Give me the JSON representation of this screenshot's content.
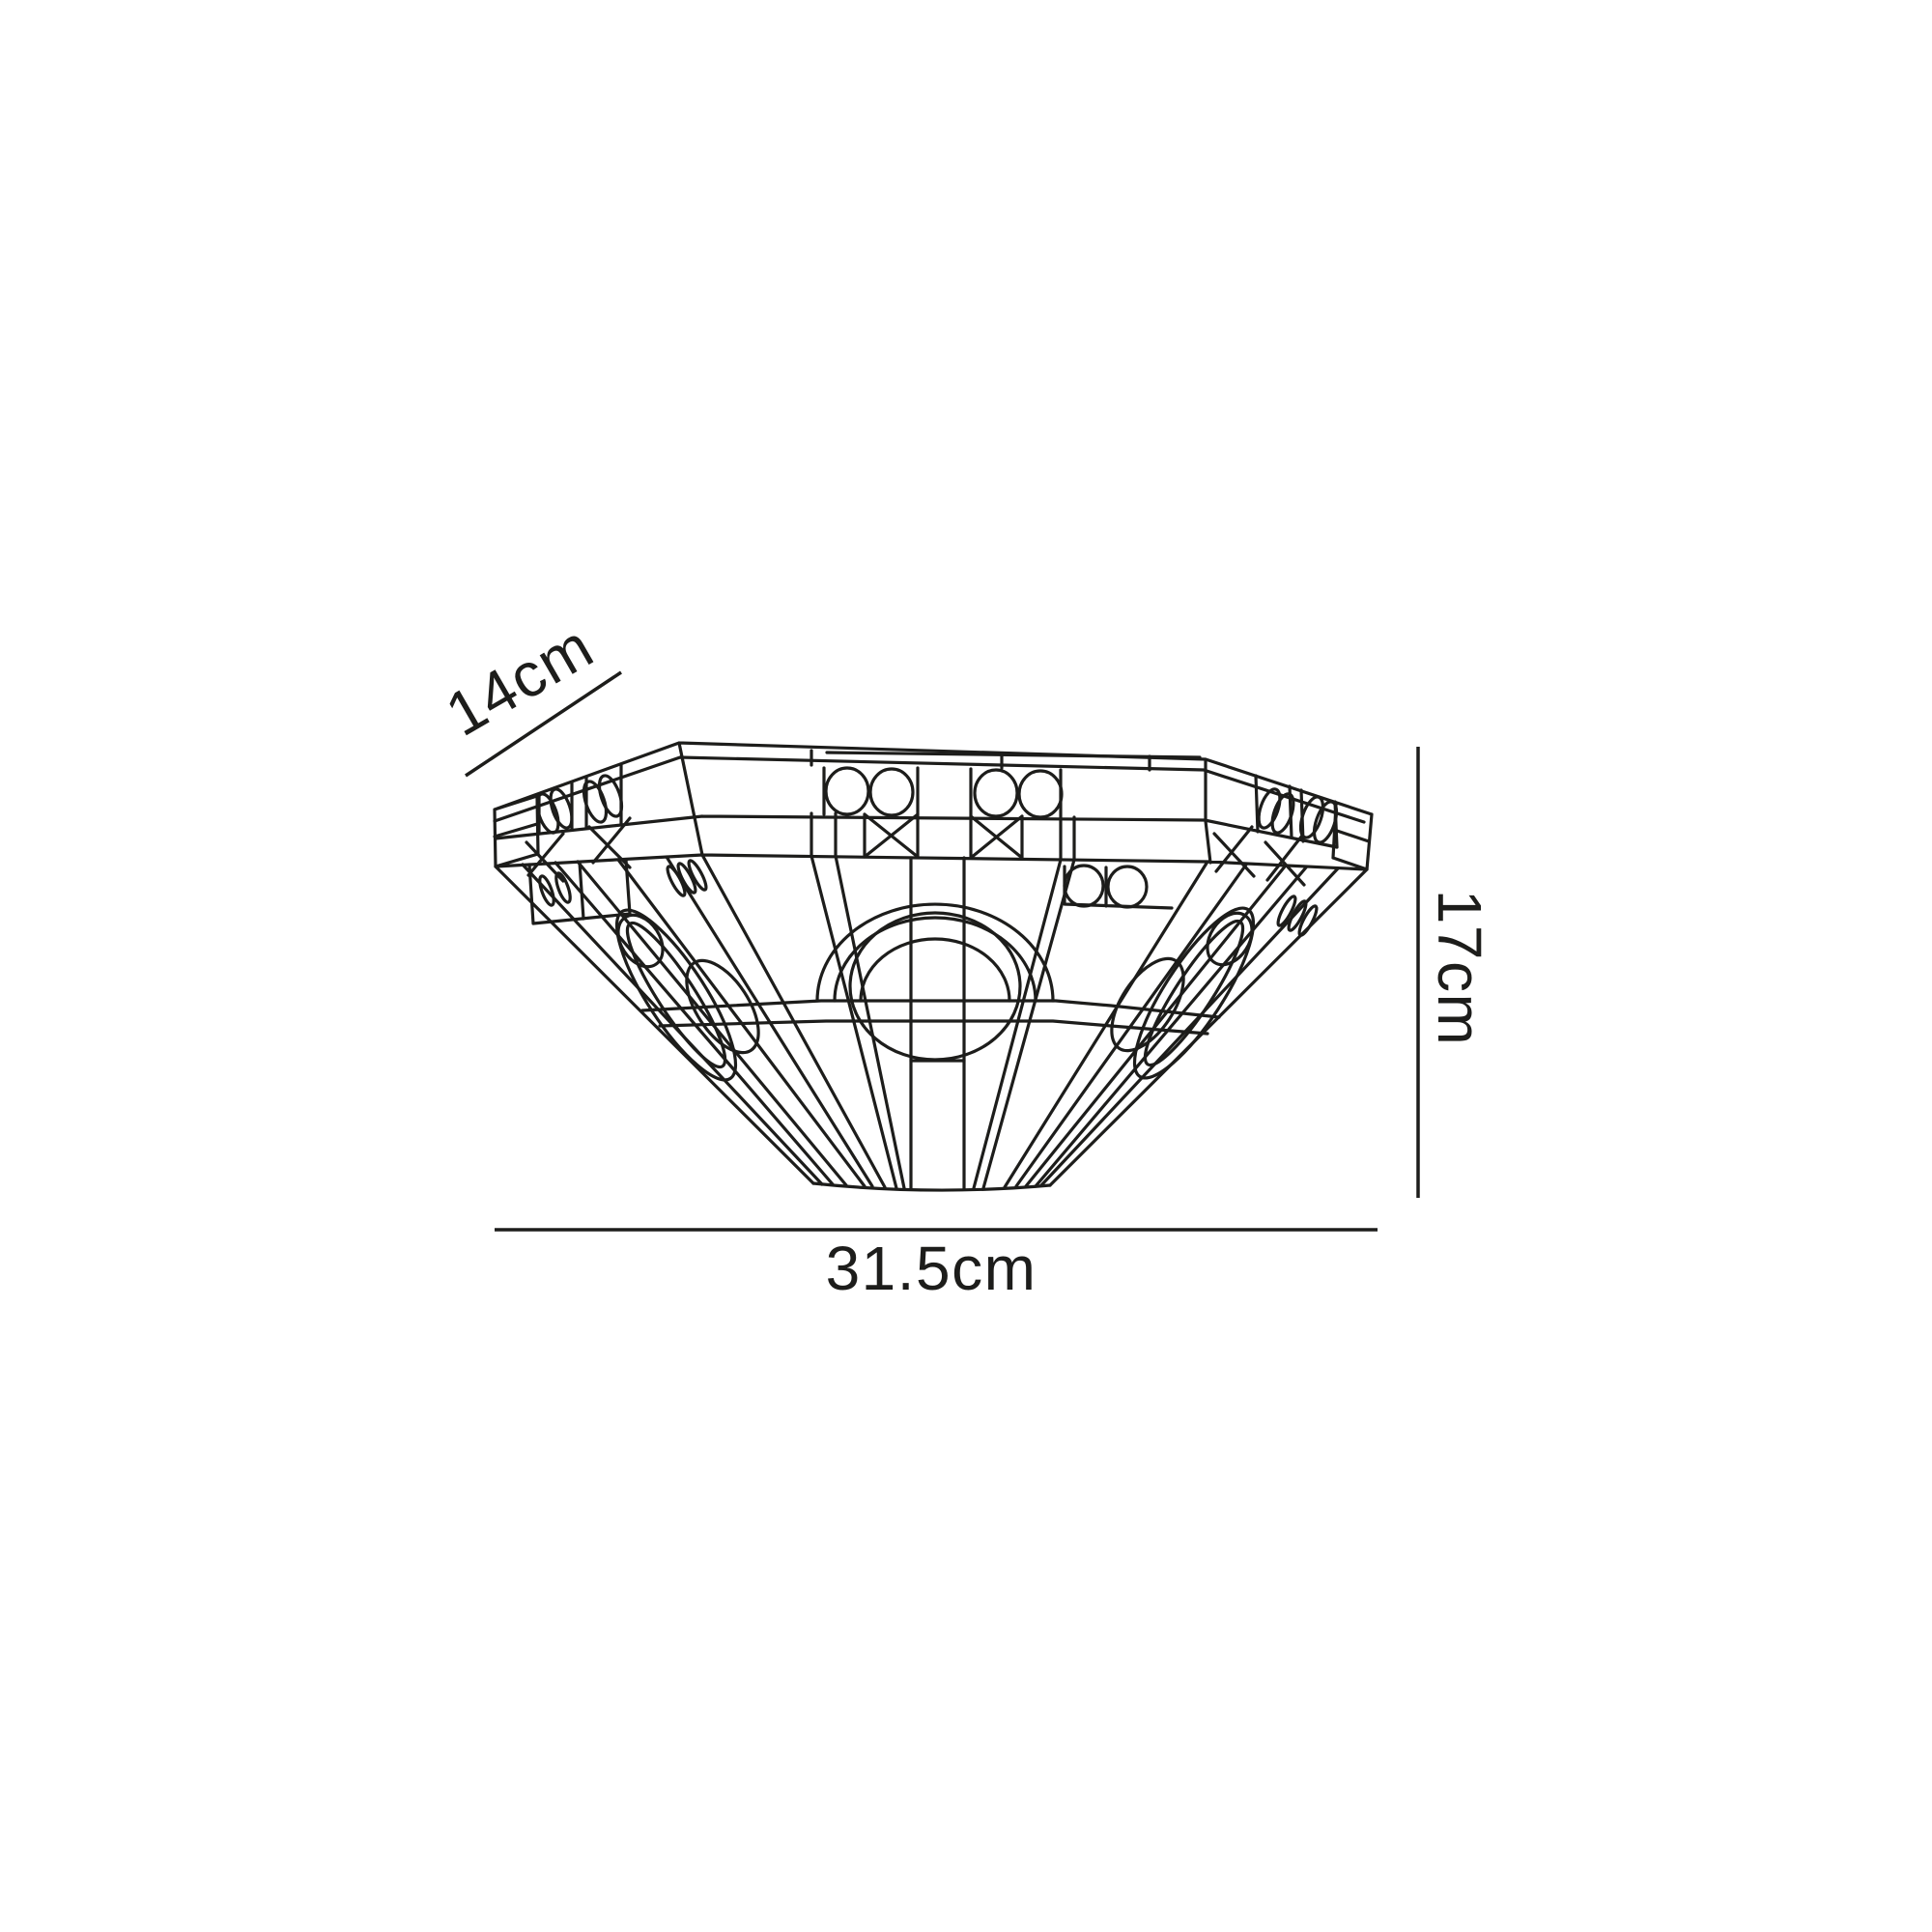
{
  "page": {
    "background": "#ffffff"
  },
  "diagram": {
    "subject": "Tiffany-style wall uplighter shade - technical wireframe line drawing",
    "stroke_color": "#1d1d1b",
    "label_color": "#1d1d1b",
    "dimensions": {
      "depth": {
        "label": "14cm"
      },
      "height": {
        "label": "17cm"
      },
      "width": {
        "label": "31.5cm"
      }
    }
  }
}
